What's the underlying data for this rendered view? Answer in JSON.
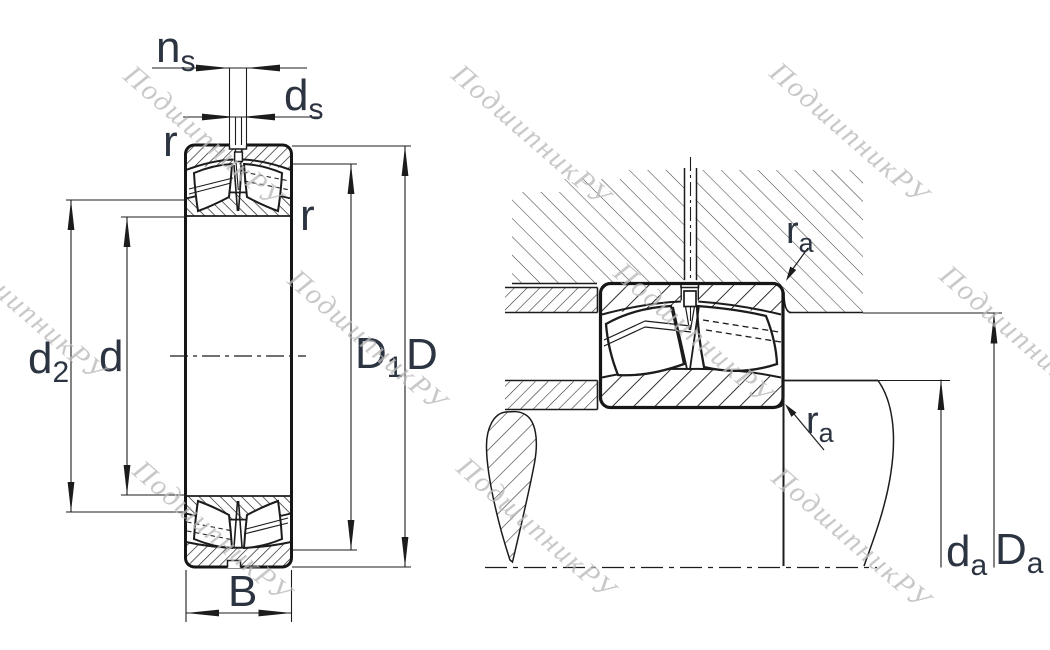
{
  "watermark": {
    "text": "ПодшипникРУ"
  },
  "figure_left": {
    "labels": {
      "ns_main": "n",
      "ns_sub": "s",
      "ds_main": "d",
      "ds_sub": "s",
      "r_top": "r",
      "r_right": "r",
      "d2_main": "d",
      "d2_sub": "2",
      "d_label": "d",
      "D1_main": "D",
      "D1_sub": "1",
      "D_label": "D",
      "B_label": "B"
    }
  },
  "figure_right": {
    "labels": {
      "ra_top_main": "r",
      "ra_top_sub": "a",
      "ra_bot_main": "r",
      "ra_bot_sub": "a",
      "da_main": "d",
      "da_sub": "a",
      "Da_main": "D",
      "Da_sub": "a"
    }
  },
  "colors": {
    "line": "#1c1c1c",
    "label": "#2b3440",
    "watermark_gray": "#b9b9b9"
  }
}
